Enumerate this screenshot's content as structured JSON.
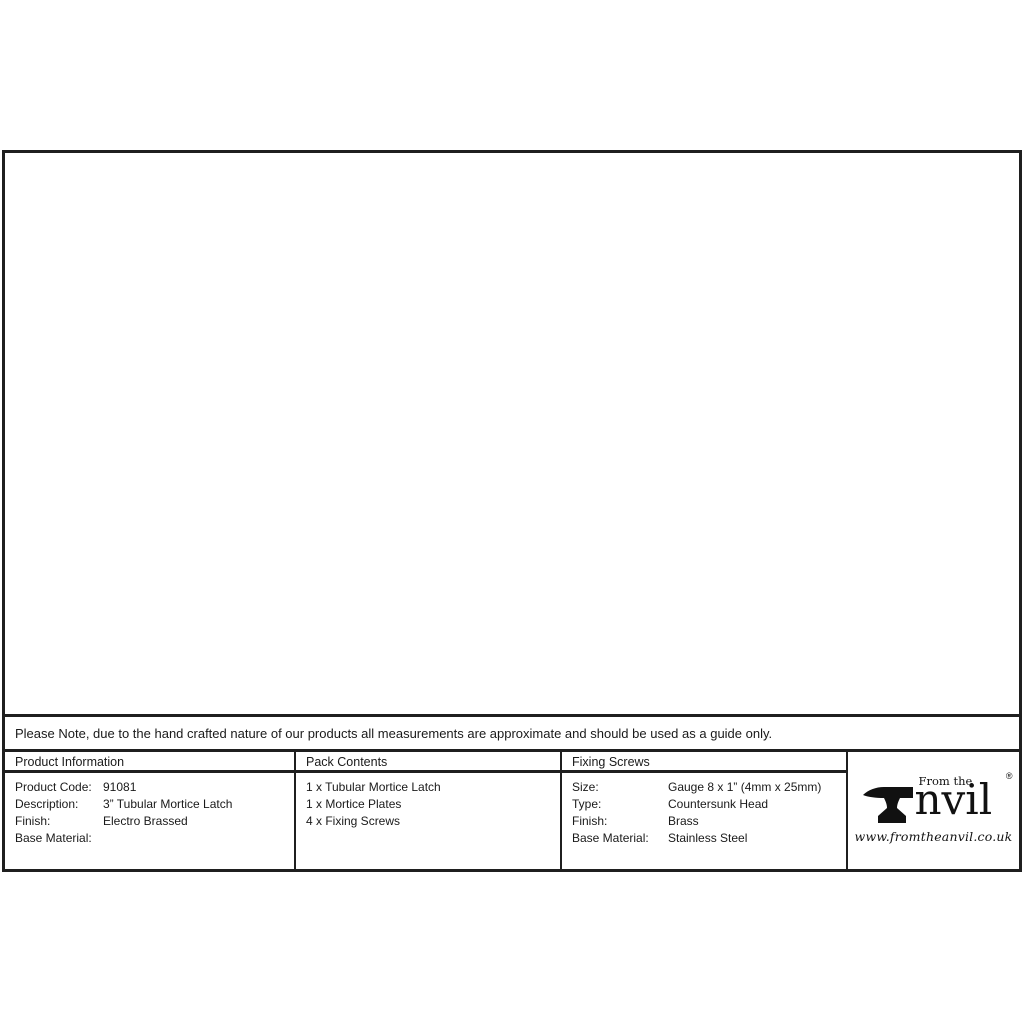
{
  "note": "Please Note, due to the hand crafted nature of our products all measurements are approximate and should be used as a guide only.",
  "drawings": {
    "strike_plate_front": {
      "top_width": "25",
      "height": "57",
      "tongue_height": "25"
    },
    "face_plate_front": {
      "width": "25",
      "height": "57"
    },
    "latch_side": {
      "backset": "56",
      "backset_label": "BACKSET",
      "body_height": "22"
    },
    "latch_top": {
      "case_length": "76",
      "overall_length": "86",
      "body_height": "15"
    },
    "strike_plate_side": {
      "length": "38",
      "lip_height": "11"
    }
  },
  "table": {
    "product_information": {
      "header": "Product Information",
      "rows": [
        {
          "label": "Product Code:",
          "value": "91081"
        },
        {
          "label": "Description:",
          "value": "3” Tubular Mortice Latch"
        },
        {
          "label": "Finish:",
          "value": "Electro Brassed"
        },
        {
          "label": "Base Material:",
          "value": ""
        }
      ]
    },
    "pack_contents": {
      "header": "Pack Contents",
      "items": [
        "1 x Tubular Mortice Latch",
        "1 x Mortice Plates",
        "4 x Fixing Screws"
      ]
    },
    "fixing_screws": {
      "header": "Fixing Screws",
      "rows": [
        {
          "label": "Size:",
          "value": "Gauge 8 x 1” (4mm x 25mm)"
        },
        {
          "label": "Type:",
          "value": "Countersunk Head"
        },
        {
          "label": "Finish:",
          "value": "Brass"
        },
        {
          "label": "Base Material:",
          "value": "Stainless Steel"
        }
      ]
    }
  },
  "logo": {
    "tagline": "From the",
    "brand": "Anvil",
    "brand_rest": "nvil",
    "registered": "®",
    "website": "www.fromtheanvil.co.uk"
  },
  "colors": {
    "line": "#222222",
    "background": "#ffffff"
  }
}
